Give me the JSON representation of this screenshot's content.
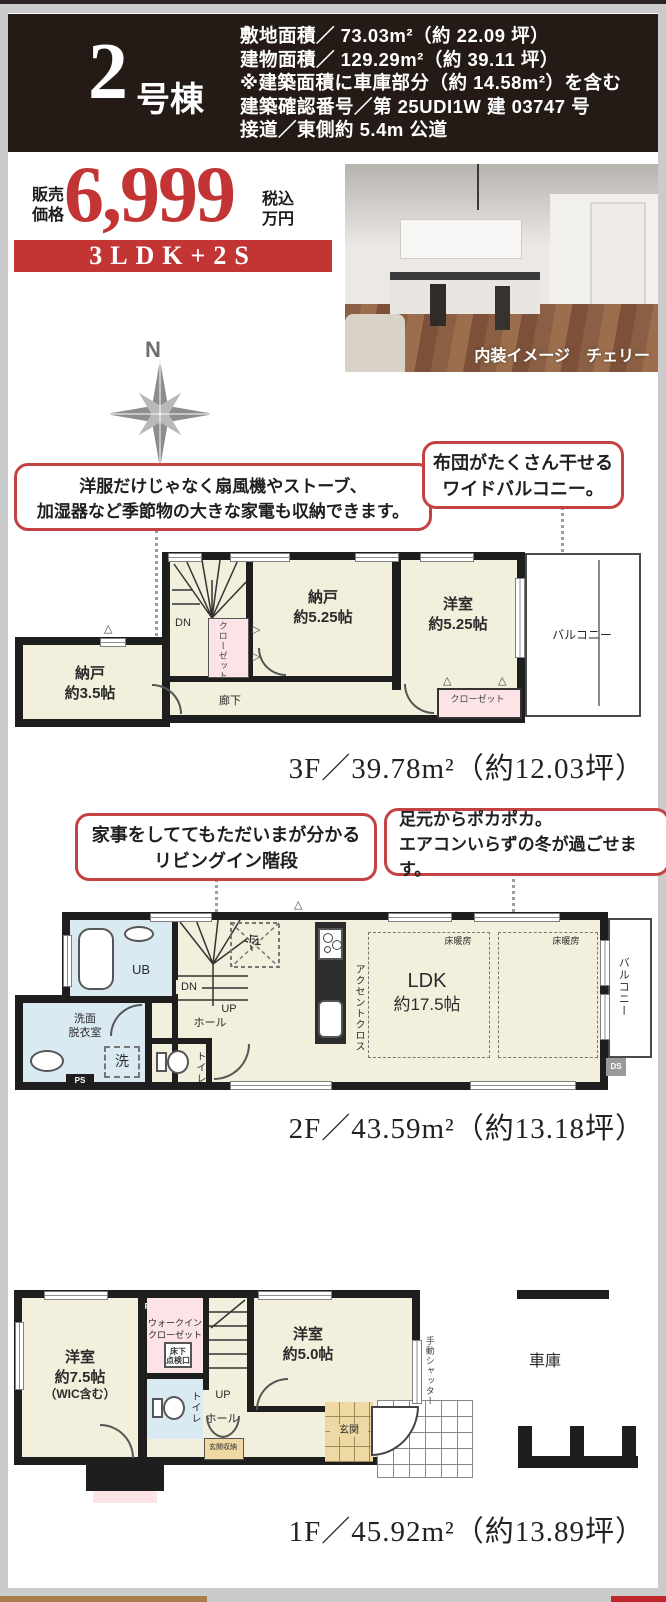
{
  "header": {
    "unit_number": "2",
    "unit_suffix": "号棟",
    "specs": [
      "敷地面積／ 73.03m²（約 22.09 坪）",
      "建物面積／ 129.29m²（約 39.11 坪）",
      "※建築面積に車庫部分（約 14.58m²）を含む",
      "建築確認番号／第 25UDI1W 建 03747 号",
      "接道／東側約 5.4m 公道"
    ]
  },
  "price": {
    "label_top": "販売",
    "label_bottom": "価格",
    "amount": "6,999",
    "unit_top": "税込",
    "unit_bottom": "万円",
    "plan": "3LDK+2S"
  },
  "photo": {
    "caption": "内装イメージ　チェリー"
  },
  "compass": {
    "north": "N"
  },
  "callouts": [
    {
      "lines": [
        "洋服だけじゃなく扇風機やストーブ、",
        "加湿器など季節物の大きな家電も収納できます。"
      ]
    },
    {
      "lines": [
        "布団がたくさん干せる",
        "ワイドバルコニー。"
      ]
    },
    {
      "lines": [
        "家事をしててもただいまが分かる",
        "リビングイン階段"
      ]
    },
    {
      "lines": [
        "足元からポカポカ。",
        "エアコンいらずの冬が過ごせます。"
      ]
    }
  ],
  "floor3": {
    "area_label": "3F／39.78m²（約12.03坪）",
    "nando35": [
      "納戸",
      "約3.5帖"
    ],
    "nando525": [
      "納戸",
      "約5.25帖"
    ],
    "yoshitsu": [
      "洋室",
      "約5.25帖"
    ],
    "closet_v": "クローゼット",
    "closet_b": "クローゼット",
    "balcony": "バルコニー",
    "corridor": "廊下",
    "dn": "DN"
  },
  "floor2": {
    "area_label": "2F／43.59m²（約13.18坪）",
    "ub": "UB",
    "senmen": [
      "洗面",
      "脱衣室"
    ],
    "wash": "洗",
    "ps": "PS",
    "toilet": "トイレ",
    "dn": "DN",
    "up": "UP",
    "hall": "ホール",
    "fridge": "冷",
    "accent": "アクセントクロス",
    "ldk": [
      "LDK",
      "約17.5帖"
    ],
    "yukadanbo": "床暖房",
    "balcony": "バルコニー",
    "ds": "DS"
  },
  "floor1": {
    "area_label": "1F／45.92m²（約13.89坪）",
    "yoshitsu75": [
      "洋室",
      "約7.5帖",
      "（WIC含む）"
    ],
    "ps": "PS",
    "wic": [
      "ウォークイン",
      "クローゼット"
    ],
    "tenken": [
      "床下",
      "点検口"
    ],
    "toilet": "トイレ",
    "up": "UP",
    "hall": "ホール",
    "shuno": "玄関収納",
    "yoshitsu50": [
      "洋室",
      "約5.0帖"
    ],
    "genkan": "玄関",
    "shutter": "手動シャッター",
    "garage": "車庫"
  }
}
